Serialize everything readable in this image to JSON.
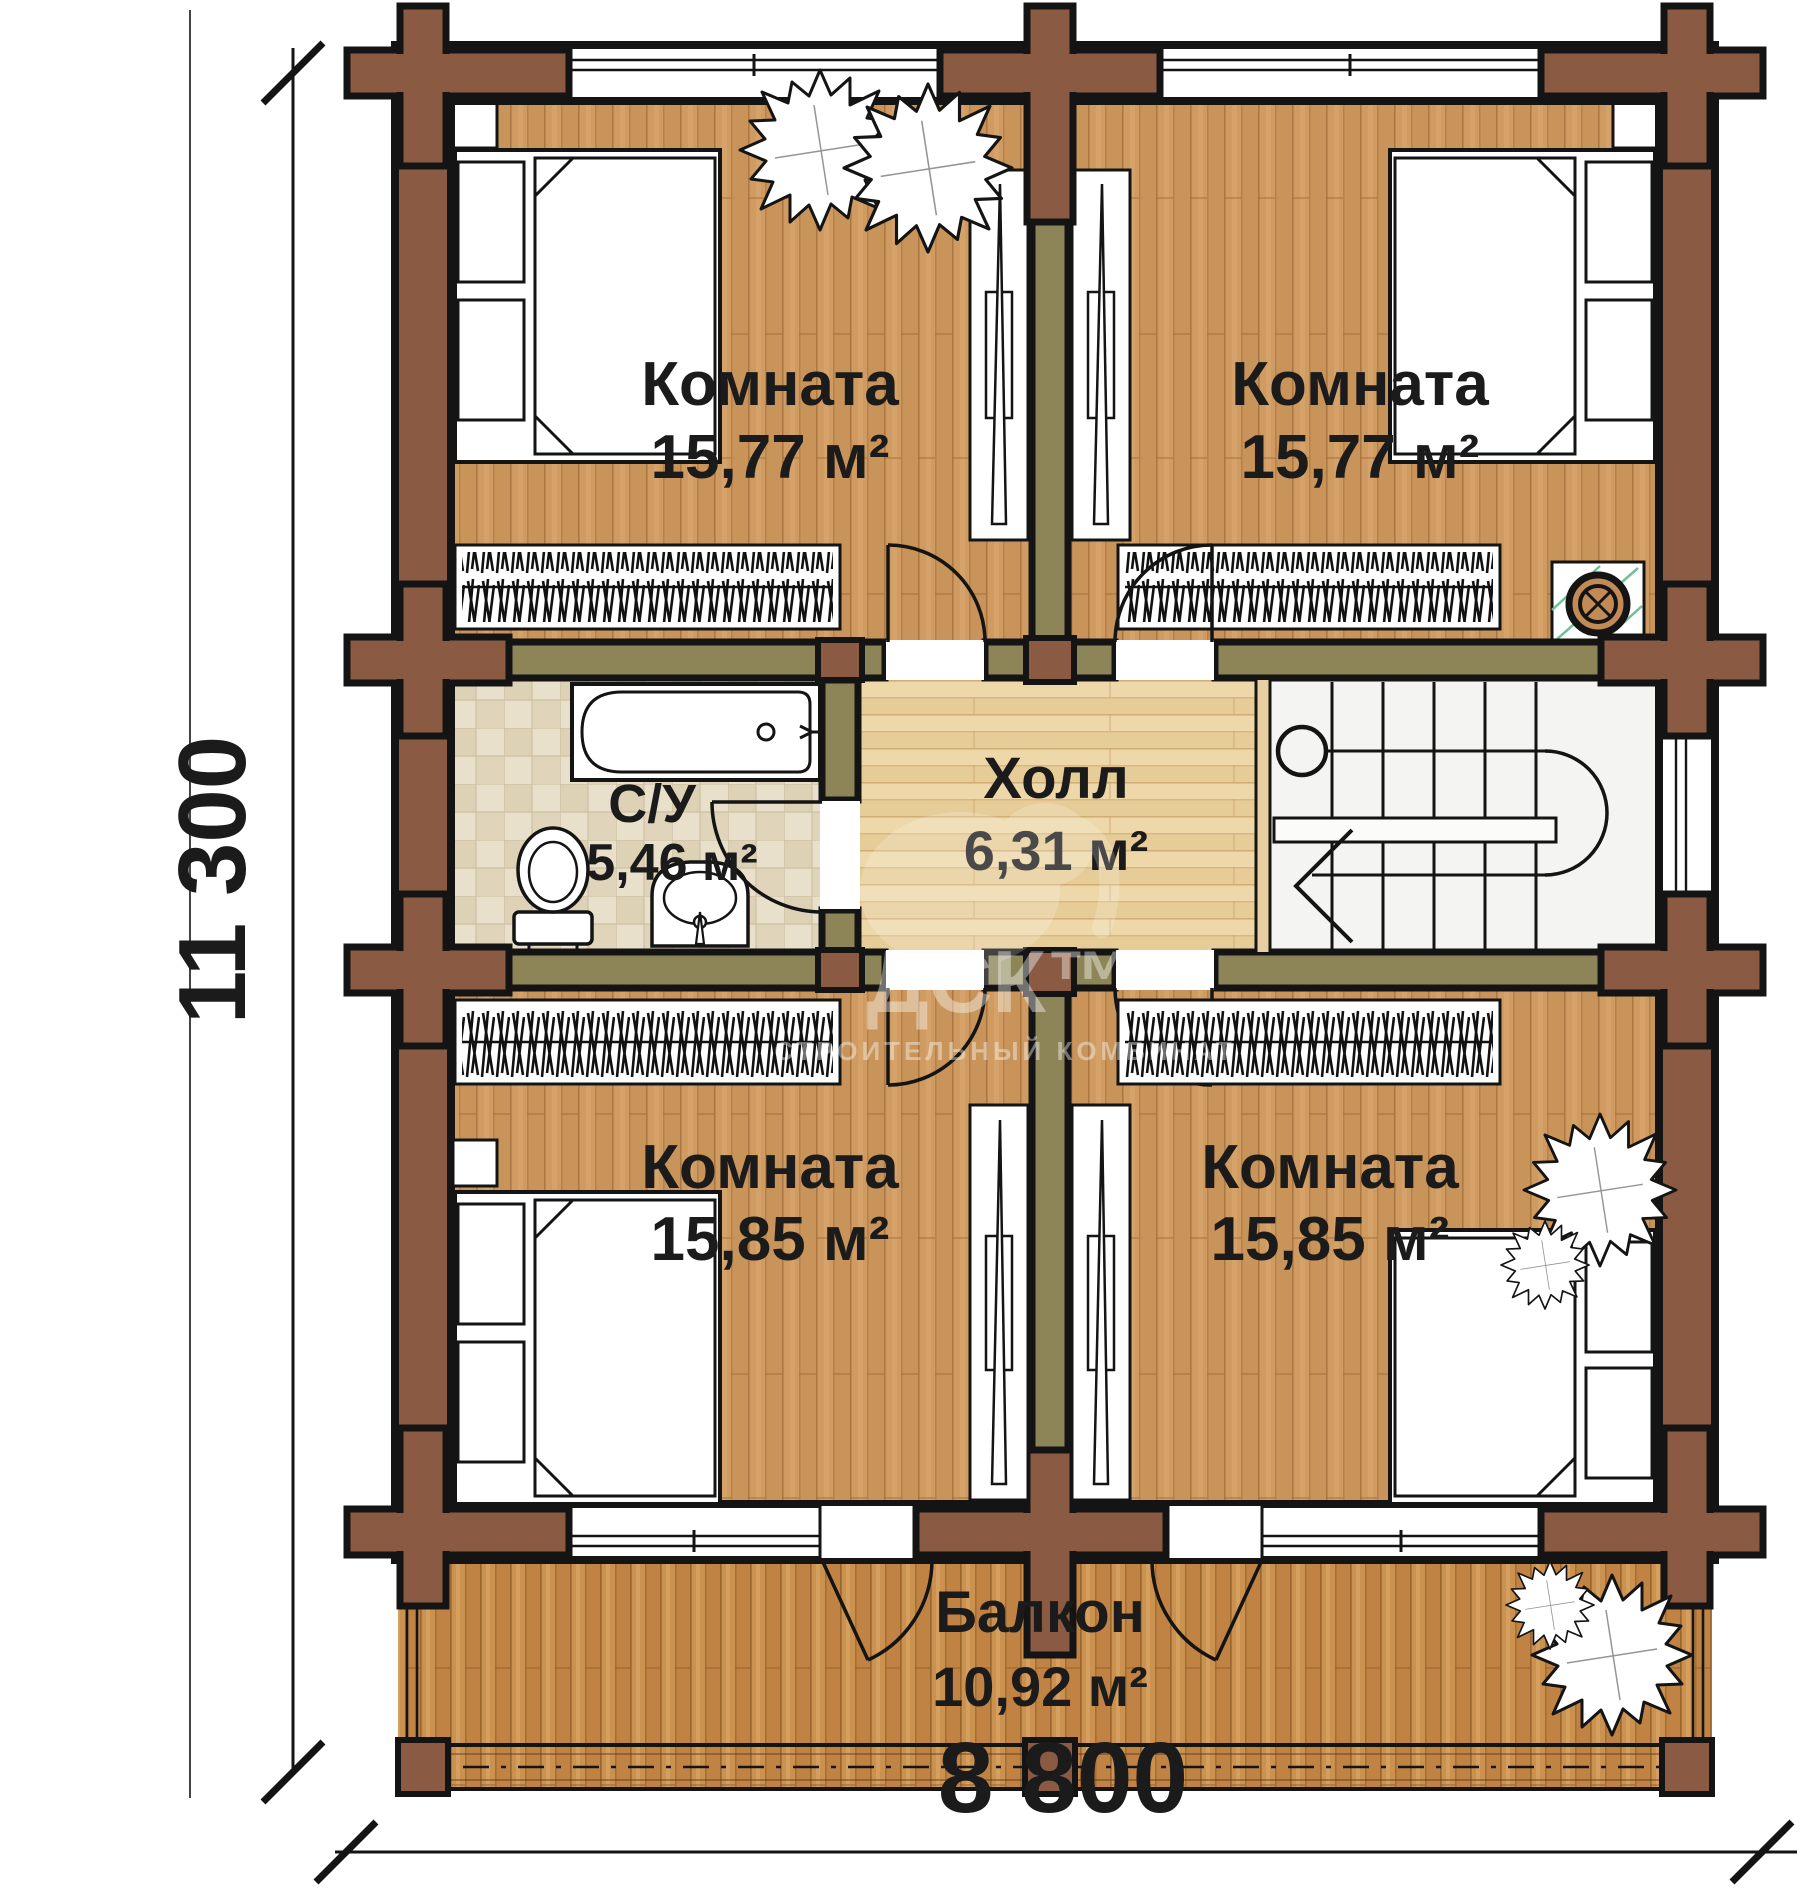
{
  "rooms": {
    "top_left": {
      "label": "Комната",
      "area": "15,77 м²"
    },
    "top_right": {
      "label": "Комната",
      "area": "15,77 м²"
    },
    "bathroom": {
      "label": "С/У",
      "area": "5,46 м²"
    },
    "hall": {
      "label": "Холл",
      "area": "6,31 м²"
    },
    "bottom_left": {
      "label": "Комната",
      "area": "15,85 м²"
    },
    "bottom_right": {
      "label": "Комната",
      "area": "15,85 м²"
    },
    "balcony": {
      "label": "Балкон",
      "area": "10,92 м²"
    }
  },
  "dimensions": {
    "overall_depth": "11 300",
    "overall_width": "8 800"
  },
  "watermark": {
    "logo": "ДСК™",
    "subtitle": "СТРОИТЕЛЬНЫЙ КОМБИНАТ"
  },
  "colors": {
    "log_wall": "#8b5a43",
    "partition_wall": "#8d8557",
    "outline": "#141414",
    "room_floor": "#cf9b60",
    "hall_floor": "#eed7a8",
    "bathroom_tile": "#e9e0cb",
    "balcony_deck": "#cb914f",
    "stair_fill": "#f4f4f2",
    "stove_hatch": "#6fc096"
  },
  "icons": [
    "bed",
    "nightstand",
    "radiator",
    "wardrobe",
    "bathtub",
    "toilet",
    "sink",
    "stairs",
    "door-arc",
    "window",
    "log-cross",
    "plant",
    "stove-flue",
    "dimension-tick"
  ]
}
